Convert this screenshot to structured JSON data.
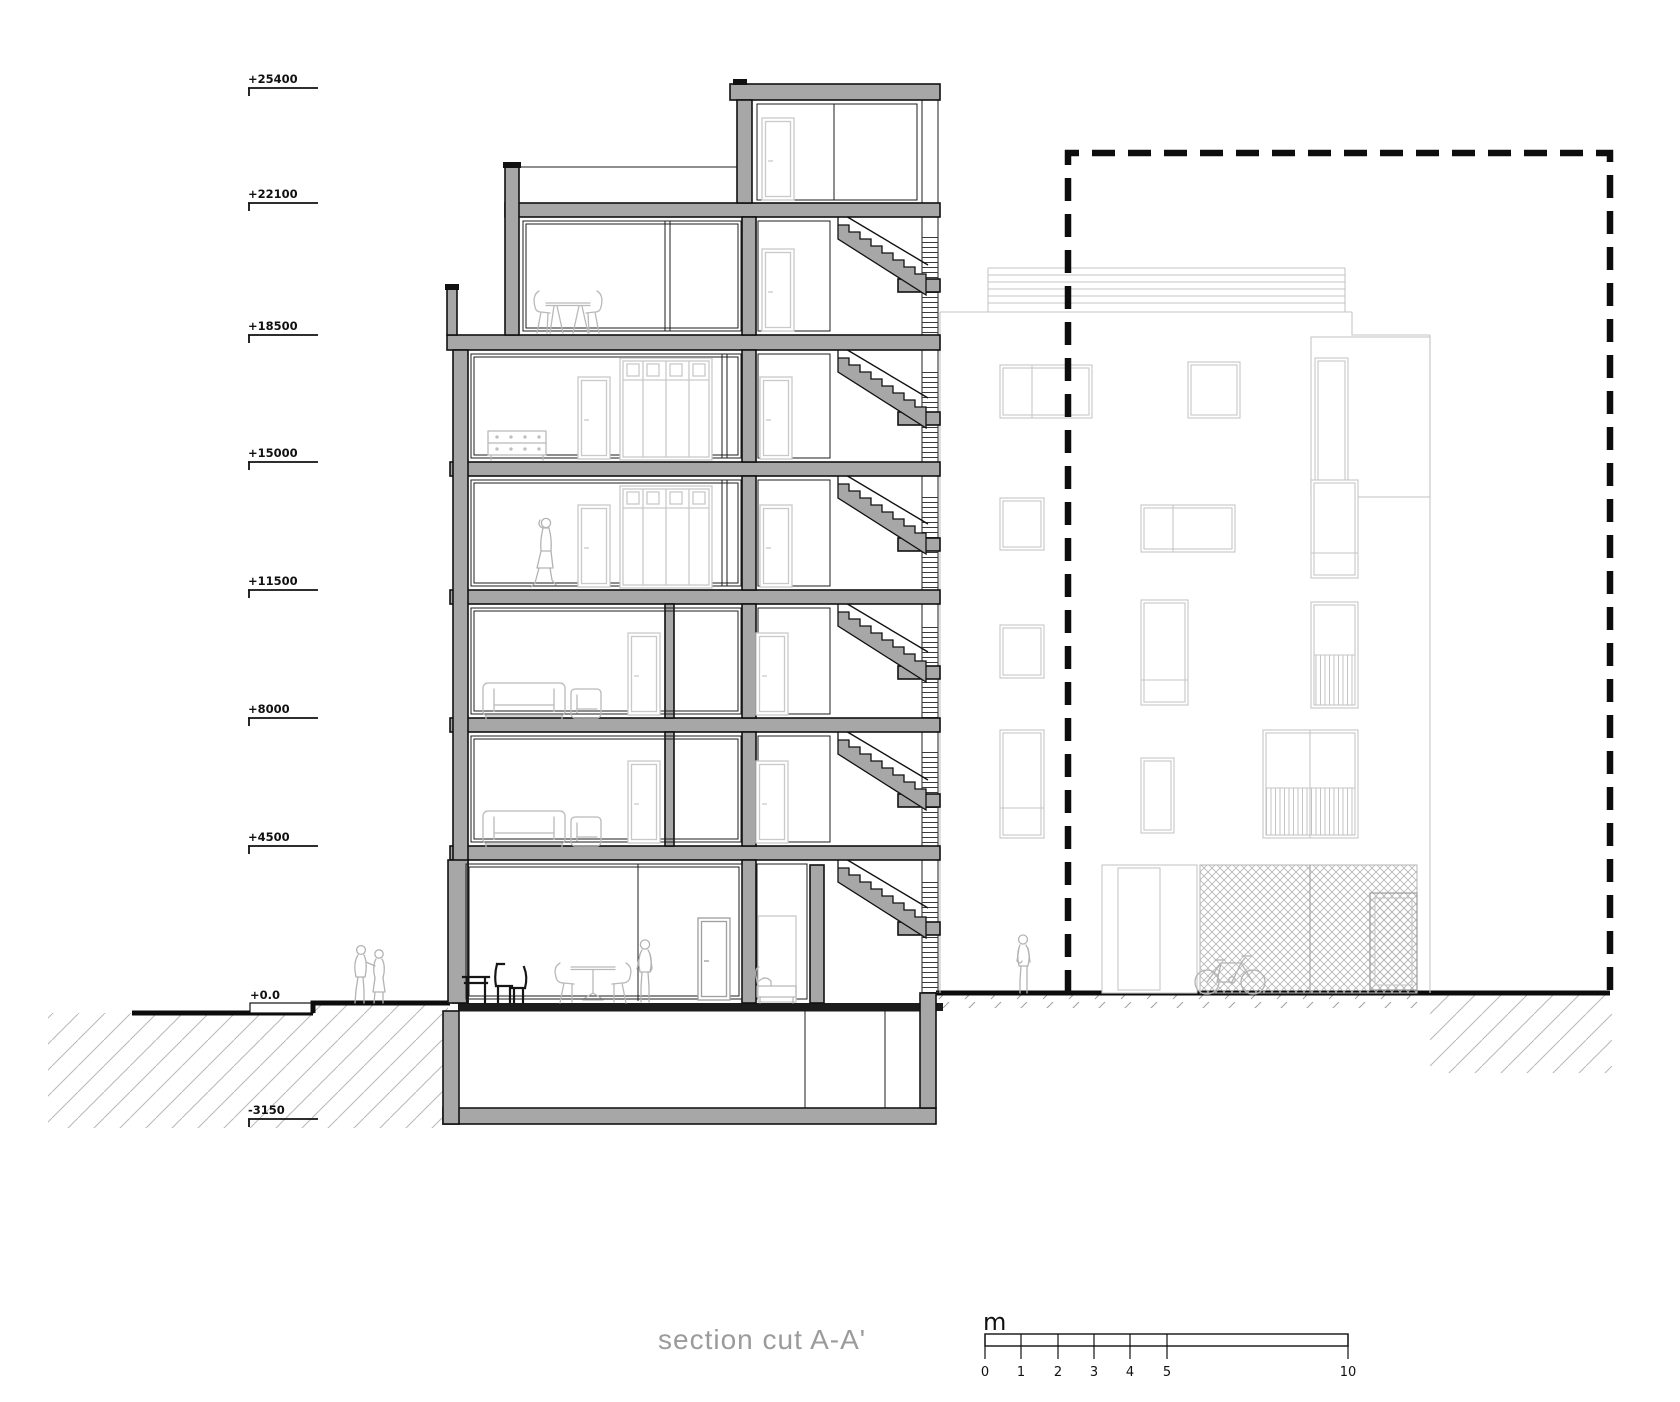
{
  "drawing_title": "section cut  A-A'",
  "levels": [
    {
      "label": "+25400"
    },
    {
      "label": "+22100"
    },
    {
      "label": "+18500"
    },
    {
      "label": "+15000"
    },
    {
      "label": "+11500"
    },
    {
      "label": "+8000"
    },
    {
      "label": "+4500"
    },
    {
      "label": "+0.0"
    },
    {
      "label": "-3150"
    }
  ],
  "scale_bar": {
    "unit": "m",
    "ticks": [
      "0",
      "1",
      "2",
      "3",
      "4",
      "5",
      "10"
    ]
  },
  "colors": {
    "cut_poche": "#a7a7a7",
    "line": "#111111",
    "light_lines": "#c6c6c6",
    "title_text": "#9b9b9b",
    "background": "#ffffff"
  }
}
